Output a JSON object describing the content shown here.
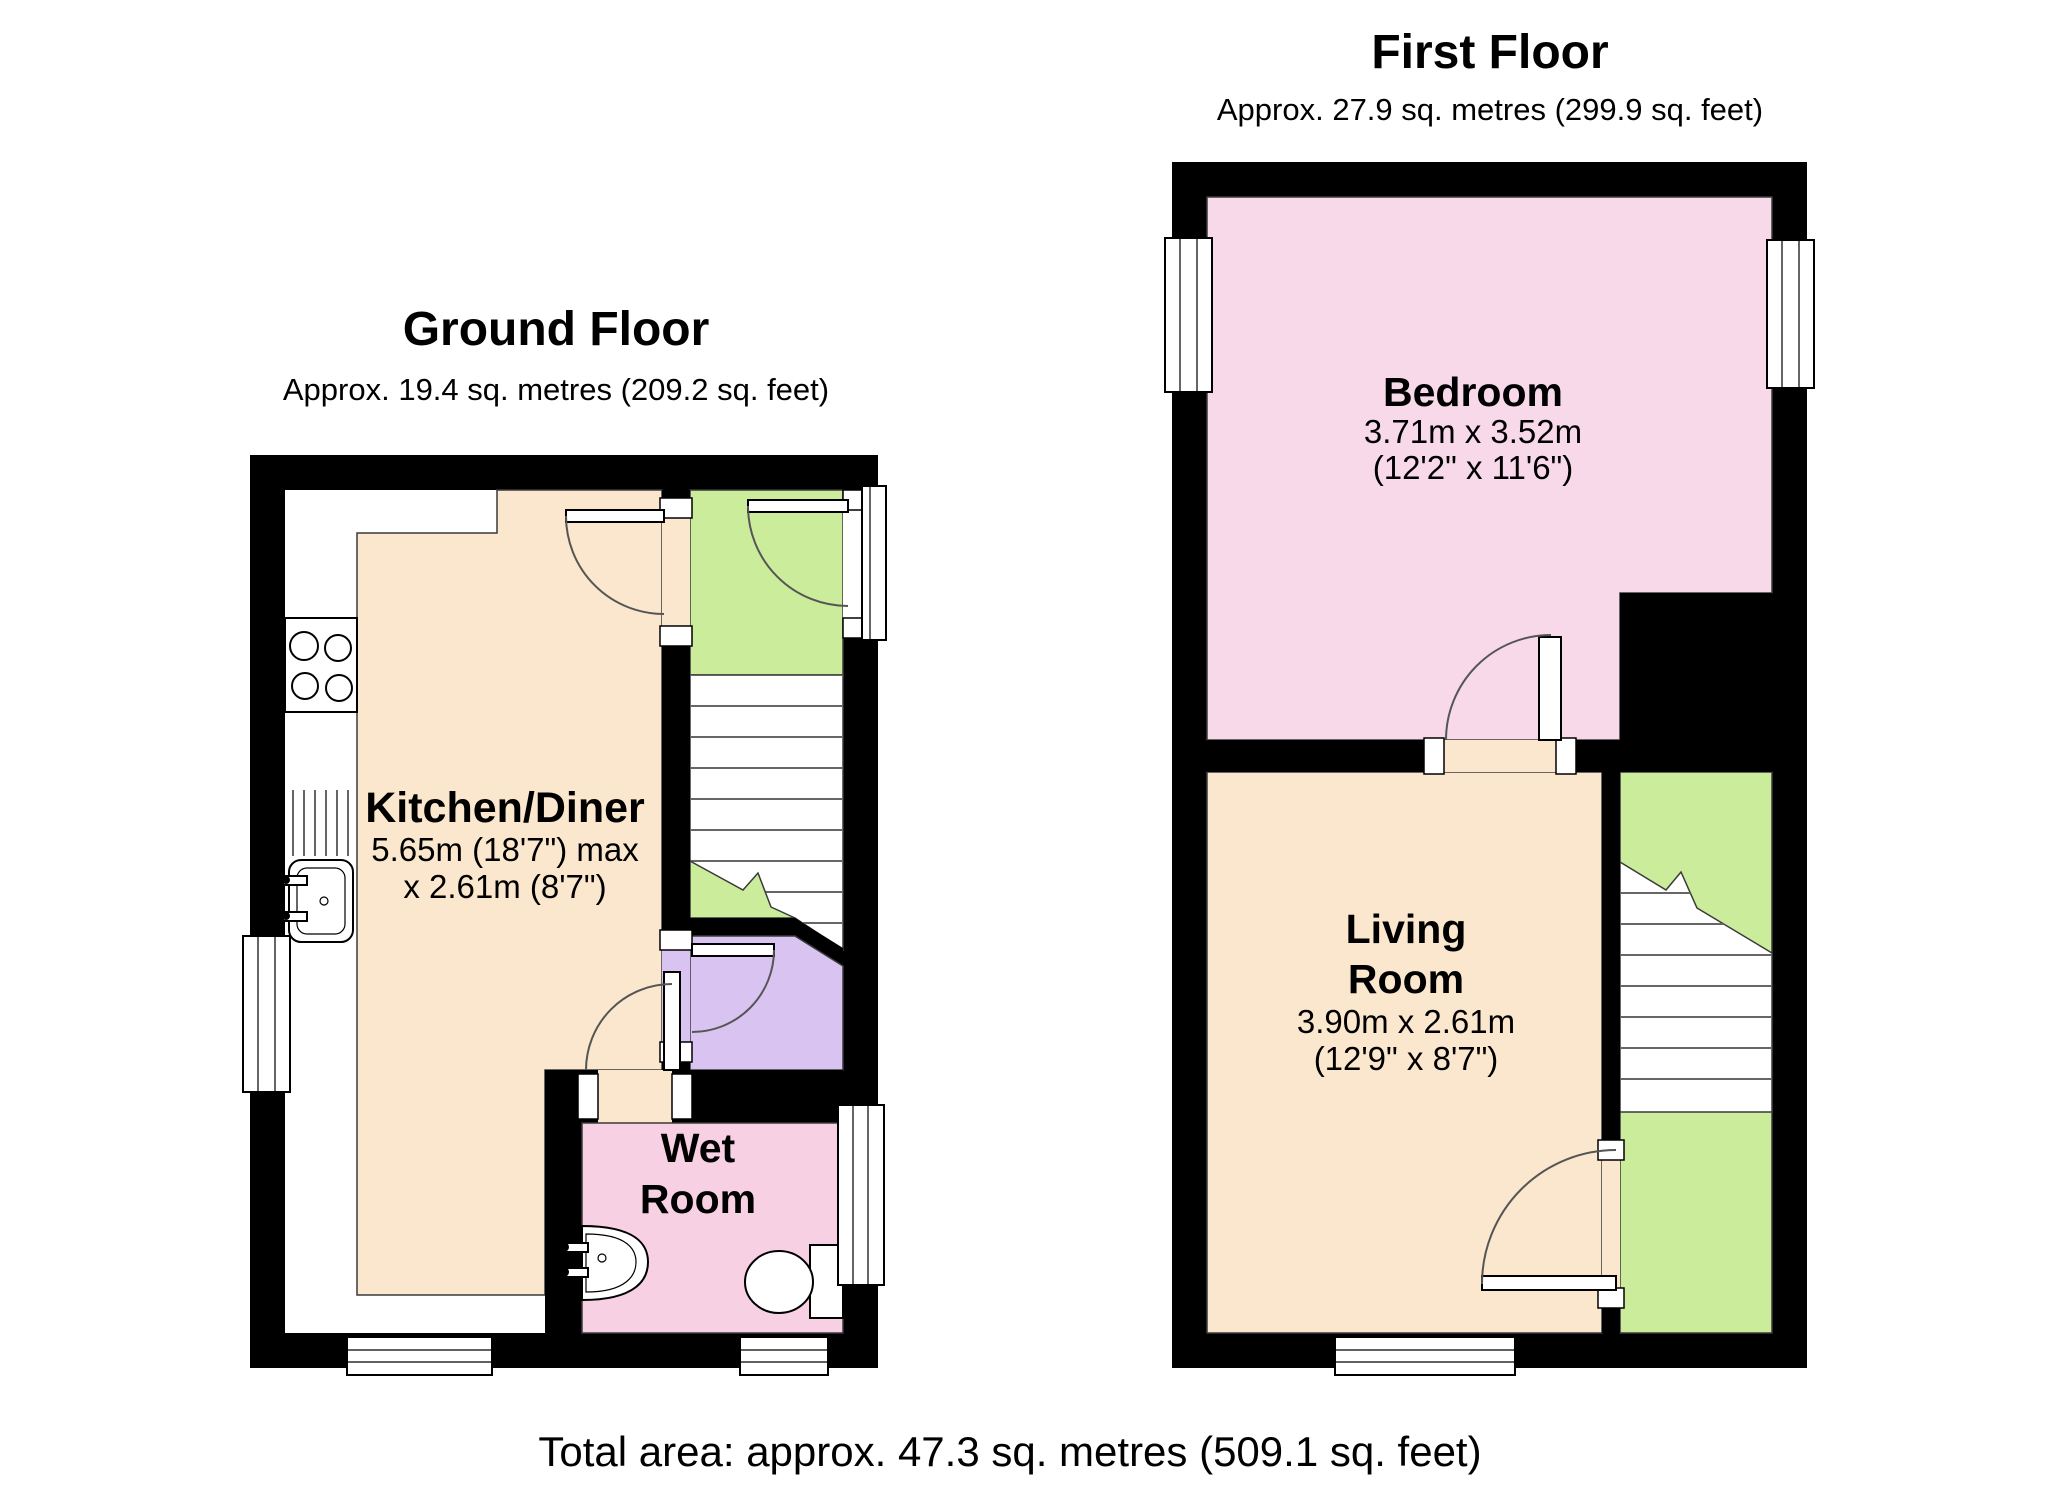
{
  "palette": {
    "wall_black": "#000000",
    "kitchen_beige": "#FAE7CD",
    "living_beige": "#FAE7CD",
    "bedroom_pink": "#F7D9EA",
    "wetroom_pink": "#F8D0E4",
    "hall_green": "#CBEC9B",
    "landing_purple": "#D9C3F0",
    "plain_white": "#FFFFFF"
  },
  "ground_floor": {
    "title": "Ground Floor",
    "subtitle": "Approx. 19.4 sq. metres (209.2 sq. feet)",
    "rooms": {
      "kitchen": {
        "name": "Kitchen/Diner",
        "dim1": "5.65m (18'7\") max",
        "dim2": "x 2.61m (8'7\")"
      },
      "wet_room": {
        "name_line1": "Wet",
        "name_line2": "Room"
      }
    }
  },
  "first_floor": {
    "title": "First Floor",
    "subtitle": "Approx. 27.9 sq. metres (299.9 sq. feet)",
    "rooms": {
      "bedroom": {
        "name": "Bedroom",
        "dim1": "3.71m x 3.52m",
        "dim2": "(12'2\" x 11'6\")"
      },
      "living_room": {
        "name_line1": "Living",
        "name_line2": "Room",
        "dim1": "3.90m x 2.61m",
        "dim2": "(12'9\" x 8'7\")"
      }
    }
  },
  "footer": {
    "total_area": "Total area: approx. 47.3 sq. metres (509.1 sq. feet)"
  }
}
